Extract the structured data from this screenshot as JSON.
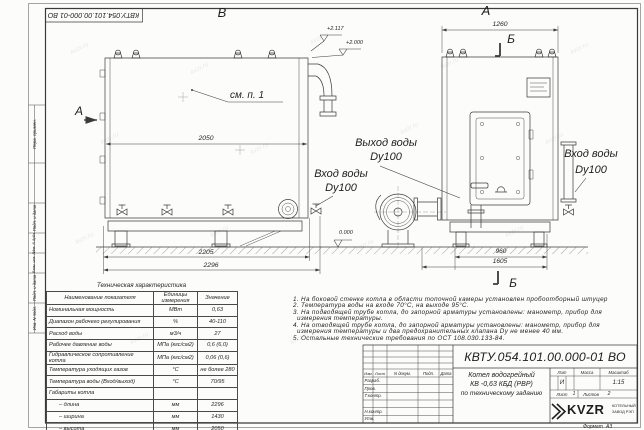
{
  "doc": {
    "number": "КВТУ.054.101.00.000-01 ВО",
    "format_label": "Формат",
    "format_value": "А3"
  },
  "watermark": "kvzr.ru",
  "margin_labels": {
    "perv": "Перв. примен.",
    "podp1": "Подп. и дата",
    "inv_dubl": "Инв. N дубл.",
    "vzam": "Взам. инв. N",
    "podp2": "Подп. и дата",
    "inv_podl": "Инв. N подл."
  },
  "views": {
    "view_b": "В",
    "view_a": "А",
    "cut_a": "А",
    "sec_b_top": "Б",
    "sec_b_bottom": "Б",
    "see_note": "см. п. 1",
    "elev_top": "+2.117",
    "elev_mid": "+2.000",
    "elev_zero": "0.000",
    "outlet": {
      "line1": "Выход воды",
      "line2": "Dy100"
    },
    "inlet_mid": {
      "line1": "Вход воды",
      "line2": "Dy100"
    },
    "inlet_right": {
      "line1": "Вход воды",
      "line2": "Dy100"
    },
    "dims": {
      "w_body": "2050",
      "l1": "2205",
      "l2": "2296",
      "front_w": "1260",
      "f1": "960",
      "f2": "1605"
    }
  },
  "spec_table": {
    "title": "Техническая характеристика",
    "headers": {
      "name": "Наименование показателя",
      "unit": "Единицы измерения",
      "value": "Значение"
    },
    "rows": [
      {
        "name": "Номинальная мощность",
        "unit": "МВт",
        "value": "0,63"
      },
      {
        "name": "Диапазон рабочего регулирования",
        "unit": "%",
        "value": "40-110"
      },
      {
        "name": "Расход воды",
        "unit": "м3/ч",
        "value": "27"
      },
      {
        "name": "Рабочее давление воды",
        "unit": "МПа (кгс/см2)",
        "value": "0,6 (6,0)"
      },
      {
        "name": "Гидравлическое сопротивление котла",
        "unit": "МПа (кгс/см2)",
        "value": "0,06 (0,6)"
      },
      {
        "name": "Температура уходящих газов",
        "unit": "°С",
        "value": "не более 280"
      },
      {
        "name": "Температура воды (Вход/выход)",
        "unit": "°С",
        "value": "70/95"
      },
      {
        "name": "Габариты котла",
        "unit": "",
        "value": ""
      },
      {
        "name": "– длина",
        "unit": "мм",
        "value": "2296"
      },
      {
        "name": "– ширина",
        "unit": "мм",
        "value": "1430"
      },
      {
        "name": "– высота",
        "unit": "мм",
        "value": "2050"
      }
    ]
  },
  "notes": {
    "lines": [
      "1.  На боковой стенке котла в области топочной камеры установлен пробоотборный штуцер",
      "2.  Температура воды на входе 70°С, на выходе 95°С.",
      "3.  На подводящей трубе котла, до запорной арматуры установлены: манометр, прибор для",
      "измерения температуры.",
      "4.  На отводящей трубе котла, до запорной арматуры установлены: манометр, прибор для",
      "измерения температуры и два предохранительных клапана Dу не менее 40 мм.",
      "5.  Остальные технические требования по ОСТ 108.030.133-84."
    ]
  },
  "title_block": {
    "cols": {
      "izm": "Изм.",
      "list": "Лист",
      "doc": "N докум.",
      "podp": "Подп.",
      "data": "Дата"
    },
    "rows": {
      "razrab": "Разраб.",
      "prov": "Пров.",
      "tkontr": "Т.контр.",
      "nkontr": "Н.контр.",
      "utv": "Утв."
    },
    "name_line1": "Котел водогрейный",
    "name_line2": "КВ -0,63 КБД (РВР)",
    "name_line3": "по техническому заданию",
    "lit_label": "Лит",
    "mass_label": "Масса",
    "scale_label": "Масштаб",
    "lit_value": "И",
    "scale_value": "1:15",
    "sheet_label": "Лист",
    "sheet_value": "1",
    "sheets_label": "Листов",
    "sheets_value": "2"
  },
  "logo": {
    "text": "KVZR",
    "sub1": "КОТЕЛЬНЫЙ",
    "sub2": "ЗАВОД РЭП"
  }
}
